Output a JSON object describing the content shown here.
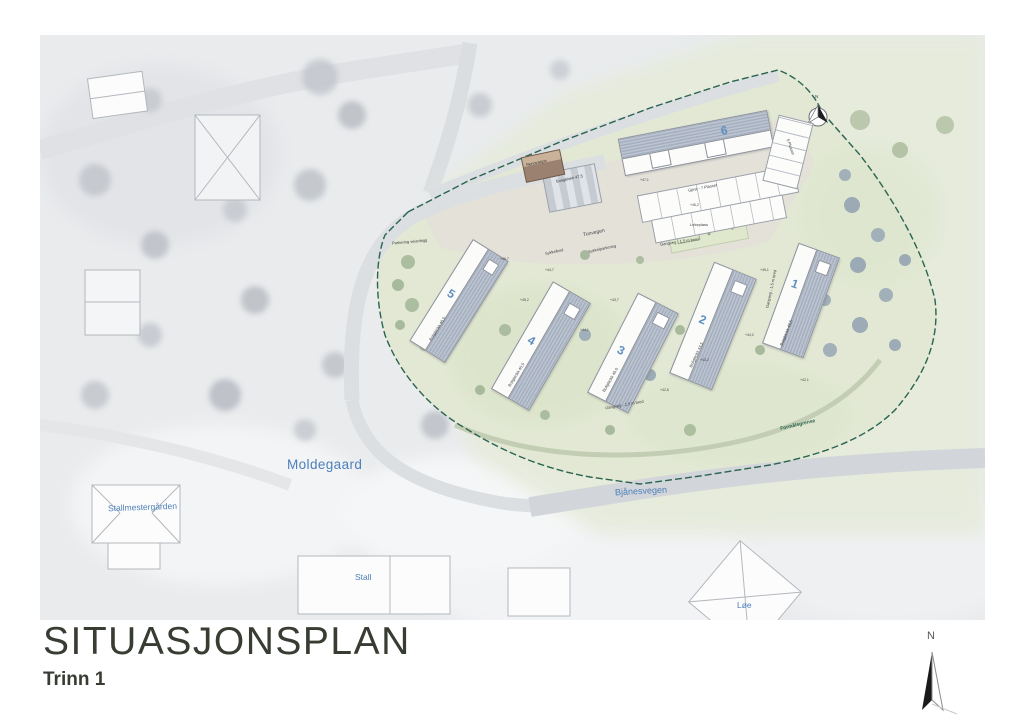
{
  "title": {
    "main": "SITUASJONSPLAN",
    "subtitle": "Trinn 1"
  },
  "north_arrow": {
    "label": "N"
  },
  "plan_compass": {
    "label": "N"
  },
  "aerial_labels": {
    "moldegaard": "Moldegaard",
    "stallmestergarden": "Stallmestergården",
    "stall": "Stall",
    "loe": "Løe",
    "bjanesvegen": "Bjånesvegen"
  },
  "site_plan": {
    "boundary_label": "Formålsgrense",
    "road_label": "Tunvegen",
    "buildings": [
      {
        "number": "1",
        "label": "Boligblokk 43,5"
      },
      {
        "number": "2",
        "label": "Boligblokk 44,5"
      },
      {
        "number": "3",
        "label": "Boligblokk 45,0"
      },
      {
        "number": "4",
        "label": "Boligblokk 45,5"
      },
      {
        "number": "5",
        "label": "Boligblokk 46,5"
      },
      {
        "number": "6",
        "label": "Boligblokk 47,5"
      }
    ],
    "features": {
      "renovasjon": "Renovasjon",
      "guest_parking": "Gjest - 7 Plasser",
      "parking_5": "5 Plasser",
      "bike_shed": "Sykkelbod",
      "bike_parking": "Sykkelparkering",
      "playground": "Lekeplass",
      "walkway_1": "Gangveg - 1,5 m bred",
      "walkway_2": "Gangveg - 1,5 m bred",
      "walkway_3": "Gangveg - 1,5 m bred",
      "road_edge": "Parkering veianlegg"
    },
    "spot_elevations": [
      "+46,7",
      "+45,2",
      "+44,7",
      "+43,7",
      "+44,1",
      "+45,1",
      "+46,2",
      "+47,1",
      "+43,2",
      "+44,2",
      "+42,6",
      "+42,1"
    ]
  },
  "colors": {
    "accent_blue": "#4d7fba",
    "number_blue": "#5e8fc0",
    "boundary_green": "#2a6450",
    "title_color": "#383d33",
    "site_green": "#e3e9d6"
  }
}
